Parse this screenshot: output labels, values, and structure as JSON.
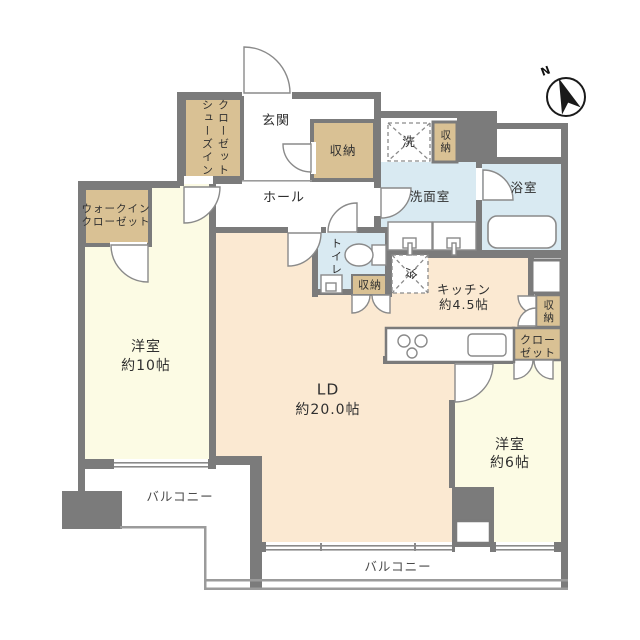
{
  "floorplan": {
    "compass": "N",
    "colors": {
      "wall": "#7b7b7b",
      "bedroom_floor": "#fcfbe4",
      "living_floor": "#fbe9d2",
      "closet_fill": "#d9c194",
      "wet_area_fill": "#d9eaf2",
      "line": "#8a8a8a"
    },
    "rooms": {
      "shoe_closet": {
        "line1": "シューズイン",
        "line2": "クローゼット"
      },
      "entrance": {
        "label": "玄関"
      },
      "entry_storage": {
        "label": "収納"
      },
      "hall": {
        "label": "ホール"
      },
      "washer": {
        "label": "洗"
      },
      "wash_storage": {
        "label": "収納"
      },
      "washroom": {
        "label": "洗面室"
      },
      "bathroom": {
        "label": "浴室"
      },
      "walkin_closet": {
        "line1": "ウォークイン",
        "line2": "クローゼット"
      },
      "toilet": {
        "label": "トイレ"
      },
      "toilet_storage": {
        "label": "収納"
      },
      "fridge": {
        "label": "冷"
      },
      "kitchen": {
        "name": "キッチン",
        "size": "約4.5帖"
      },
      "closet": {
        "line1": "クロー",
        "line2": "ゼット"
      },
      "right_storage": {
        "label": "収納"
      },
      "bedroom10": {
        "name": "洋室",
        "size": "約10帖"
      },
      "living_dining": {
        "name": "LD",
        "size": "約20.0帖"
      },
      "bedroom6": {
        "name": "洋室",
        "size": "約6帖"
      },
      "balcony_left": {
        "label": "バルコニー"
      },
      "balcony_bottom": {
        "label": "バルコニー"
      }
    }
  }
}
